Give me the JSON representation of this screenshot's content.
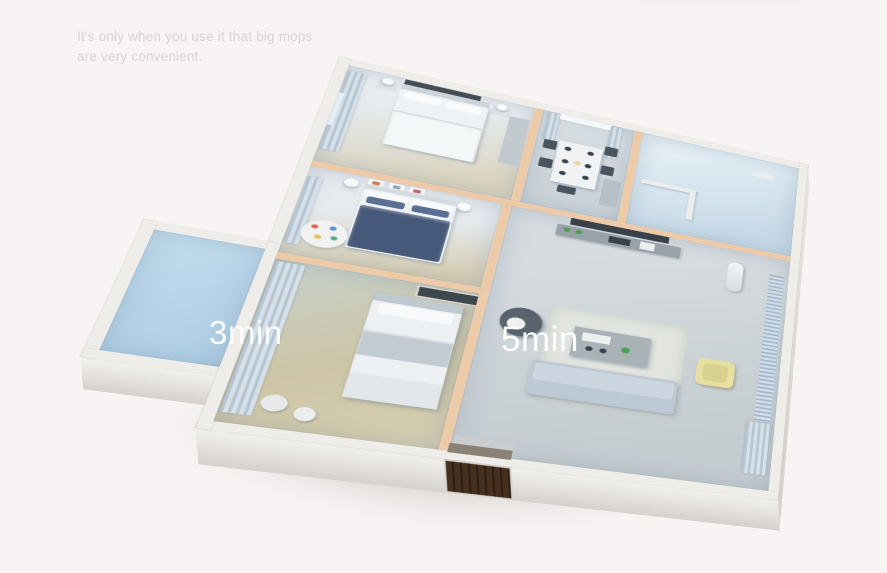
{
  "caption": {
    "line1": "It's only when you use it that big mops",
    "line2": "are very convenient."
  },
  "labels": {
    "bedroom_time": "3min",
    "living_room_time": "5min"
  },
  "floorplan": {
    "rooms": [
      {
        "id": "master-bedroom"
      },
      {
        "id": "kids-bedroom"
      },
      {
        "id": "small-bedroom",
        "time_label": "3min"
      },
      {
        "id": "dining-room"
      },
      {
        "id": "bathroom"
      },
      {
        "id": "living-room",
        "time_label": "5min"
      },
      {
        "id": "balcony"
      }
    ],
    "entrance": {
      "door": "dark-wood-entry-door"
    }
  },
  "colors": {
    "bg": "#f7f4f3",
    "caption": "#d7d3d2",
    "label": "#ffffff",
    "wall_int": "#edcba9",
    "wall_ext": "#efede9",
    "face_light": "#f3f1ee",
    "face_dark": "#d5d2ce",
    "door": "#3a2817",
    "floor_cool": "#ccd4d9",
    "floor_wood": "#cdc5a8",
    "floor_balcony": "#b7d3e8",
    "curtain_a": "#b6c5d2",
    "curtain_b": "#d6e0e8",
    "bed_white": "#eff2f4",
    "duvet_navy": "#47597a",
    "sofa": "#bcc9d5",
    "armchair": "#e6e1a3",
    "egg": "#59636d",
    "tv": "#39424a",
    "dark": "#49545e",
    "plant": "#4f9e57"
  }
}
